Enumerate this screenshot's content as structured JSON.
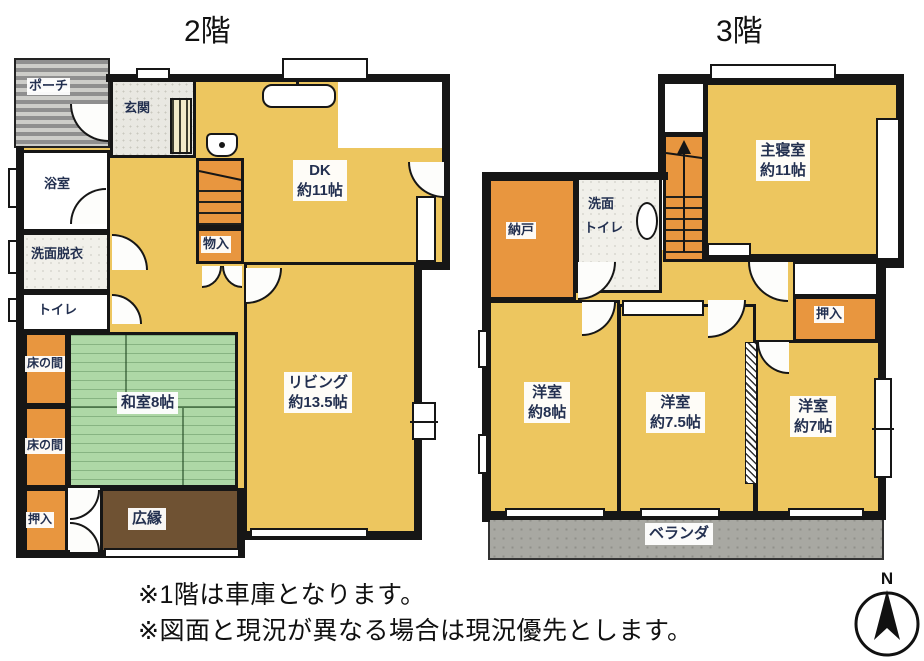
{
  "floor2": {
    "title": "2階",
    "rooms": {
      "porch": "ポーチ",
      "genkan": "玄関",
      "dk": {
        "name": "DK",
        "size": "約11帖"
      },
      "bath": "浴室",
      "washroom": "洗面脱衣",
      "toilet": "トイレ",
      "monoire": "物入",
      "tokonoma": "床の間",
      "washitsu": "和室8帖",
      "oshiire": "押入",
      "hiroen": "広縁",
      "living": {
        "name": "リビング",
        "size": "約13.5帖"
      }
    }
  },
  "floor3": {
    "title": "3階",
    "rooms": {
      "master": {
        "name": "主寝室",
        "size": "約11帖"
      },
      "nando": "納戸",
      "senmen_line1": "洗面",
      "senmen_line2": "トイレ",
      "oshiire": "押入",
      "yoshitsu8": {
        "name": "洋室",
        "size": "約8帖"
      },
      "yoshitsu75": {
        "name": "洋室",
        "size": "約7.5帖"
      },
      "yoshitsu7": {
        "name": "洋室",
        "size": "約7帖"
      },
      "veranda": "ベランダ"
    }
  },
  "notes": {
    "line1": "※1階は車庫となります。",
    "line2": "※図面と現況が異なる場合は現況優先とします。"
  },
  "compass": {
    "north": "N"
  },
  "colors": {
    "floor_yellow": "#EDC65F",
    "closet_orange": "#E8963F",
    "tatami_green": "#AED8A6",
    "hiroen_brown": "#6F5233",
    "balcony_gray": "#A8A8A2",
    "wall_black": "#161616"
  }
}
